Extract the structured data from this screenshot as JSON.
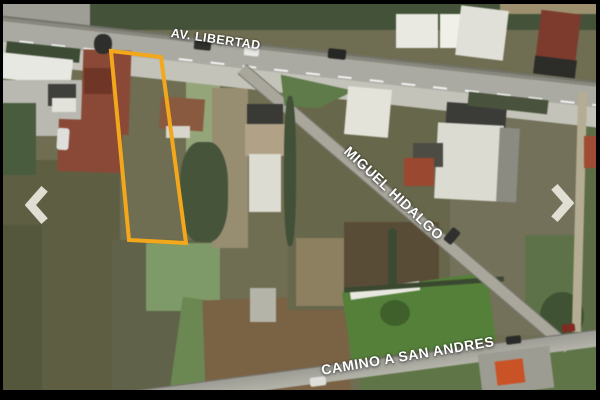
{
  "photo": {
    "type": "satellite-aerial-photo",
    "subject": "vacant land lot outlined for sale"
  },
  "street_labels": {
    "top": "AV. LIBERTAD",
    "diagonal": "MIGUEL HIDALGO",
    "bottom": "CAMINO A SAN ANDRES"
  },
  "lot_highlight": {
    "points": "111,51 161,57 186,243 129,240",
    "stroke_color": "#F3A71B",
    "stroke_width": 4
  },
  "carousel_nav": {
    "prev_icon": "chevron-left",
    "next_icon": "chevron-right",
    "icon_color": "#E7E4DB"
  },
  "colors": {
    "lot_outline": "#F3A71B",
    "street_label_text": "#FFFFFF",
    "letterbox": "#000000"
  }
}
